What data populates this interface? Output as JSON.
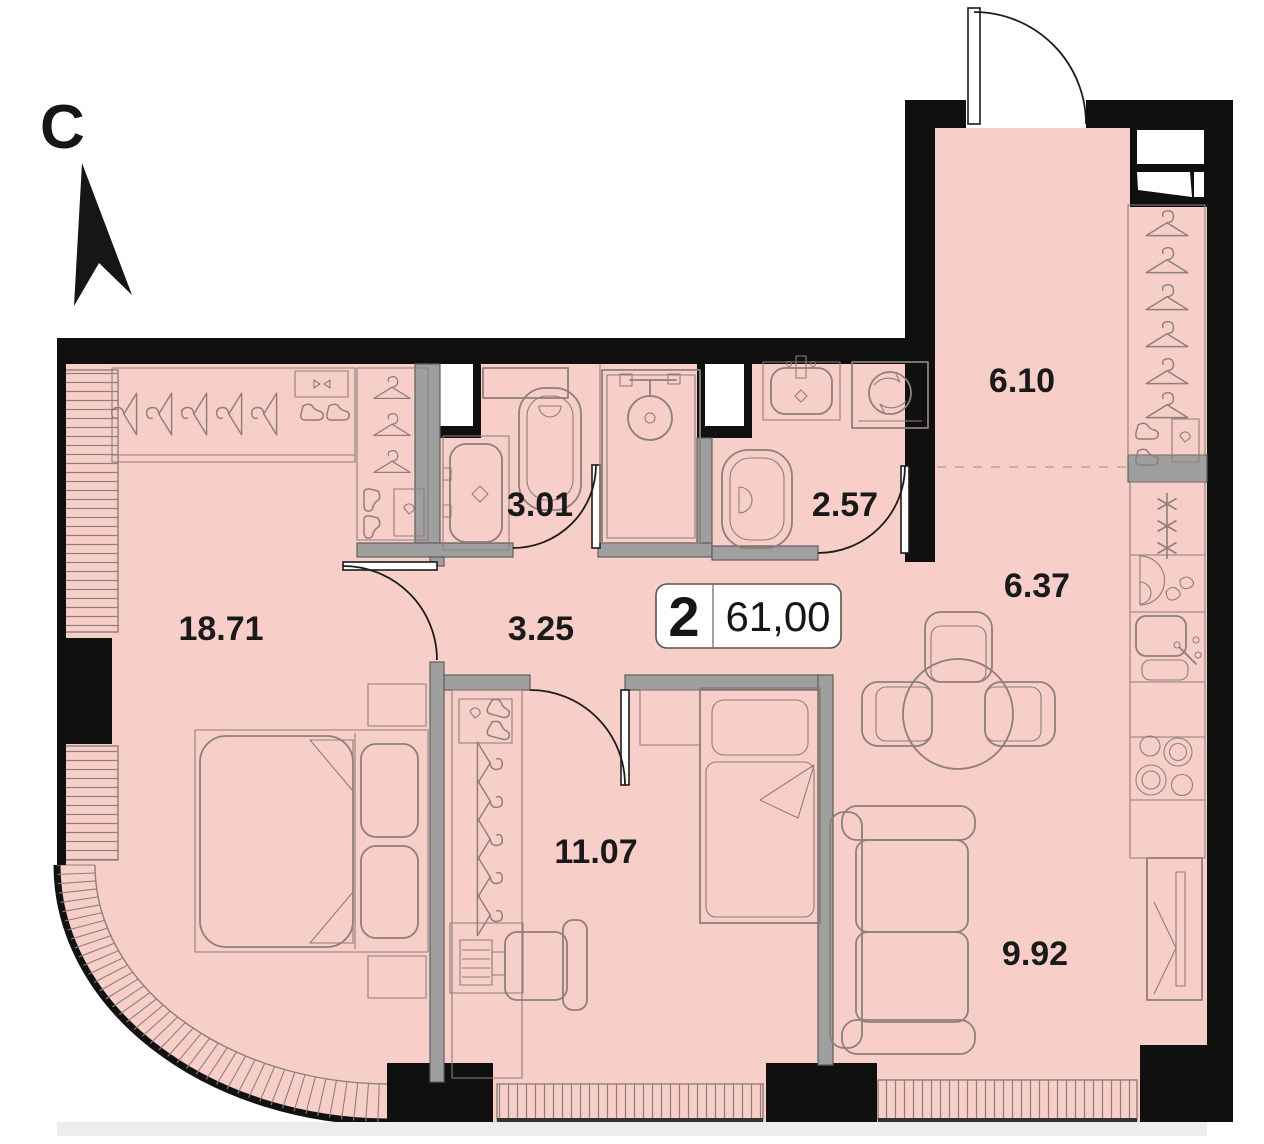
{
  "plan": {
    "compass_label": "C",
    "badge": {
      "rooms_count": "2",
      "total_area": "61,00"
    },
    "rooms": [
      {
        "id": "bedroom-main",
        "area_label": "18.71"
      },
      {
        "id": "bathroom-1",
        "area_label": "3.01"
      },
      {
        "id": "hallway",
        "area_label": "3.25"
      },
      {
        "id": "bathroom-2",
        "area_label": "2.57"
      },
      {
        "id": "entry-hall",
        "area_label": "6.10"
      },
      {
        "id": "kitchen",
        "area_label": "6.37"
      },
      {
        "id": "bedroom-2",
        "area_label": "11.07"
      },
      {
        "id": "living-area",
        "area_label": "9.92"
      }
    ],
    "colors": {
      "floor": "#f8cec9",
      "wall": "#101010",
      "partition": "#9f9f9f",
      "furniture_line": "#8e7f7a",
      "label_text": "#1a1a1a"
    },
    "icons": [
      "north-arrow",
      "double-bed",
      "single-bed",
      "sofa",
      "dining-table",
      "wardrobe-hangers",
      "kitchen-stove",
      "kitchen-sink",
      "fridge",
      "washing-machine",
      "toilet",
      "shower",
      "sink-vanity",
      "desk-chair",
      "mirror-cabinet",
      "entrance-door"
    ]
  }
}
